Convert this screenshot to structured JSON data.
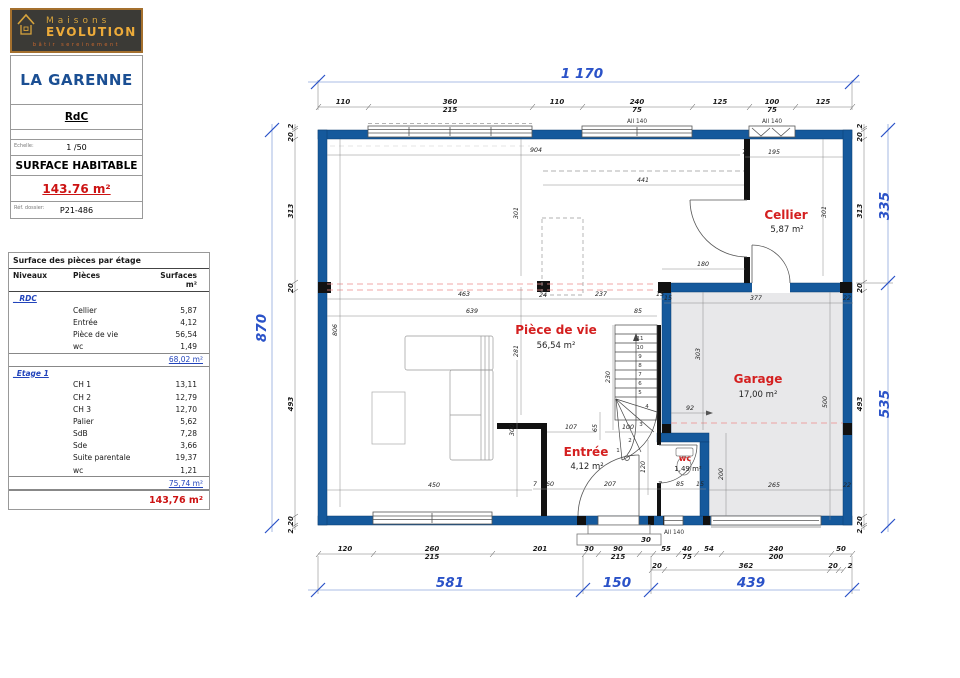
{
  "logo": {
    "brand_top": "Maisons",
    "brand_bottom": "EVOLUTION",
    "tagline": "bâtir sereinement"
  },
  "titleblock": {
    "project": "LA GARENNE",
    "level": "RdC",
    "scale_label": "Echelle:",
    "scale_value": "1 /50",
    "surface_label": "SURFACE HABITABLE",
    "surface_value": "143.76 m²",
    "ref_label": "Réf. dossier:",
    "ref_value": "P21-486"
  },
  "table": {
    "title": "Surface des pièces par étage",
    "col_niveaux": "Niveaux",
    "col_pieces": "Pièces",
    "col_surfaces": "Surfaces m²",
    "rdc_label": "_ RDC",
    "rdc_rows": [
      {
        "name": "Cellier",
        "area": "5,87"
      },
      {
        "name": "Entrée",
        "area": "4,12"
      },
      {
        "name": "Pièce de vie",
        "area": "56,54"
      },
      {
        "name": "wc",
        "area": "1,49"
      }
    ],
    "rdc_total": "68,02 m²",
    "etage_label": "_Etage 1",
    "etage_rows": [
      {
        "name": "CH 1",
        "area": "13,11"
      },
      {
        "name": "CH 2",
        "area": "12,79"
      },
      {
        "name": "CH 3",
        "area": "12,70"
      },
      {
        "name": "Palier",
        "area": "5,62"
      },
      {
        "name": "SdB",
        "area": "7,28"
      },
      {
        "name": "Sde",
        "area": "3,66"
      },
      {
        "name": "Suite parentale",
        "area": "19,37"
      },
      {
        "name": "wc",
        "area": "1,21"
      }
    ],
    "etage_total": "75,74 m²",
    "grand_total": "143,76 m²"
  },
  "plan": {
    "rooms": [
      {
        "name": "Pièce de vie",
        "area": "56,54 m²"
      },
      {
        "name": "Cellier",
        "area": "5,87 m²"
      },
      {
        "name": "Garage",
        "area": "17,00 m²"
      },
      {
        "name": "Entrée",
        "area": "4,12 m²"
      },
      {
        "name": "wc",
        "area": "1,49 m²"
      }
    ],
    "overall": {
      "top": "1 170",
      "left": "870",
      "right_top": "335",
      "right_bottom": "535",
      "bottom": [
        "581",
        "150",
        "439"
      ]
    },
    "allege_label": "All 140",
    "top_chain": [
      "110",
      "360",
      "110",
      "240",
      "125",
      "100",
      "125"
    ],
    "top_chain_sub": [
      "215",
      "75",
      "75"
    ],
    "left_chain": [
      "2",
      "20",
      "313",
      "20",
      "493",
      "20",
      "2"
    ],
    "bottom_chain": [
      "120",
      "260",
      "201",
      "30",
      "90",
      "30",
      "55",
      "40",
      "54",
      "240",
      "50"
    ],
    "bottom_chain_sub": [
      "215",
      "215",
      "75",
      "200"
    ],
    "bottom_chain2": [
      "20",
      "362",
      "20",
      "2"
    ],
    "interior": {
      "d904": "904",
      "d441": "441",
      "d195": "195",
      "d7a": "7",
      "d301c": "301",
      "d180": "180",
      "d463": "463",
      "d24": "24",
      "d237": "237",
      "d15a": "15",
      "d639": "639",
      "d85a": "85",
      "d806": "806",
      "d281": "281",
      "d230": "230",
      "d301k": "301",
      "d450": "450",
      "d300": "300",
      "d107": "107",
      "d100": "100",
      "d65": "65",
      "d207": "207",
      "d60": "60",
      "d7b": "7",
      "d7c": "7",
      "d85b": "85",
      "d15b": "15",
      "d120": "120",
      "d377": "377",
      "d22a": "22",
      "d15g": "15",
      "d303": "303",
      "d500": "500",
      "d92": "92",
      "d200": "200",
      "d265": "265",
      "d22b": "22"
    },
    "stairs": [
      "1",
      "2",
      "3",
      "4",
      "5",
      "6",
      "7",
      "8",
      "9",
      "10",
      "11"
    ]
  }
}
